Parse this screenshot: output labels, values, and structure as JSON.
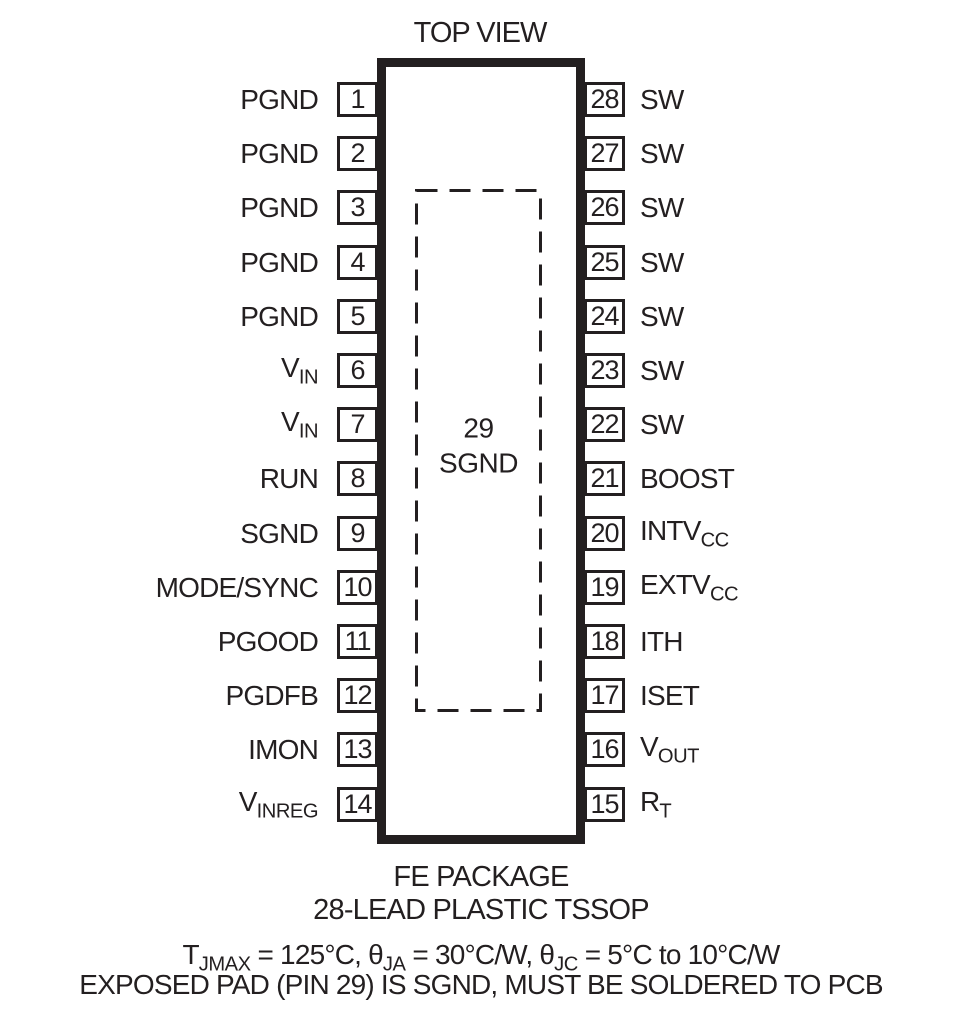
{
  "title": "TOP VIEW",
  "package": {
    "exposed_pad_number": "29",
    "exposed_pad_name": "SGND",
    "name_line1": "FE PACKAGE",
    "name_line2": "28-LEAD PLASTIC TSSOP"
  },
  "pins": {
    "left": [
      {
        "number": "1",
        "base": "PGND",
        "sub": ""
      },
      {
        "number": "2",
        "base": "PGND",
        "sub": ""
      },
      {
        "number": "3",
        "base": "PGND",
        "sub": ""
      },
      {
        "number": "4",
        "base": "PGND",
        "sub": ""
      },
      {
        "number": "5",
        "base": "PGND",
        "sub": ""
      },
      {
        "number": "6",
        "base": "V",
        "sub": "IN"
      },
      {
        "number": "7",
        "base": "V",
        "sub": "IN"
      },
      {
        "number": "8",
        "base": "RUN",
        "sub": ""
      },
      {
        "number": "9",
        "base": "SGND",
        "sub": ""
      },
      {
        "number": "10",
        "base": "MODE/SYNC",
        "sub": ""
      },
      {
        "number": "11",
        "base": "PGOOD",
        "sub": ""
      },
      {
        "number": "12",
        "base": "PGDFB",
        "sub": ""
      },
      {
        "number": "13",
        "base": "IMON",
        "sub": ""
      },
      {
        "number": "14",
        "base": "V",
        "sub": "INREG"
      }
    ],
    "right": [
      {
        "number": "28",
        "base": "SW",
        "sub": ""
      },
      {
        "number": "27",
        "base": "SW",
        "sub": ""
      },
      {
        "number": "26",
        "base": "SW",
        "sub": ""
      },
      {
        "number": "25",
        "base": "SW",
        "sub": ""
      },
      {
        "number": "24",
        "base": "SW",
        "sub": ""
      },
      {
        "number": "23",
        "base": "SW",
        "sub": ""
      },
      {
        "number": "22",
        "base": "SW",
        "sub": ""
      },
      {
        "number": "21",
        "base": "BOOST",
        "sub": ""
      },
      {
        "number": "20",
        "base": "INTV",
        "sub": "CC"
      },
      {
        "number": "19",
        "base": "EXTV",
        "sub": "CC"
      },
      {
        "number": "18",
        "base": "ITH",
        "sub": ""
      },
      {
        "number": "17",
        "base": "ISET",
        "sub": ""
      },
      {
        "number": "16",
        "base": "V",
        "sub": "OUT"
      },
      {
        "number": "15",
        "base": "R",
        "sub": "T"
      }
    ]
  },
  "notes": {
    "line1_segments": [
      {
        "text": "T"
      },
      {
        "sub": "JMAX"
      },
      {
        "text": " = 125°C, θ"
      },
      {
        "sub": "JA"
      },
      {
        "text": " = 30°C/W, θ"
      },
      {
        "sub": "JC"
      },
      {
        "text": " = 5°C to 10°C/W"
      }
    ],
    "line2": "EXPOSED PAD (PIN 29) IS SGND, MUST BE SOLDERED TO PCB"
  },
  "colors": {
    "ink": "#231f20",
    "background": "#ffffff"
  }
}
